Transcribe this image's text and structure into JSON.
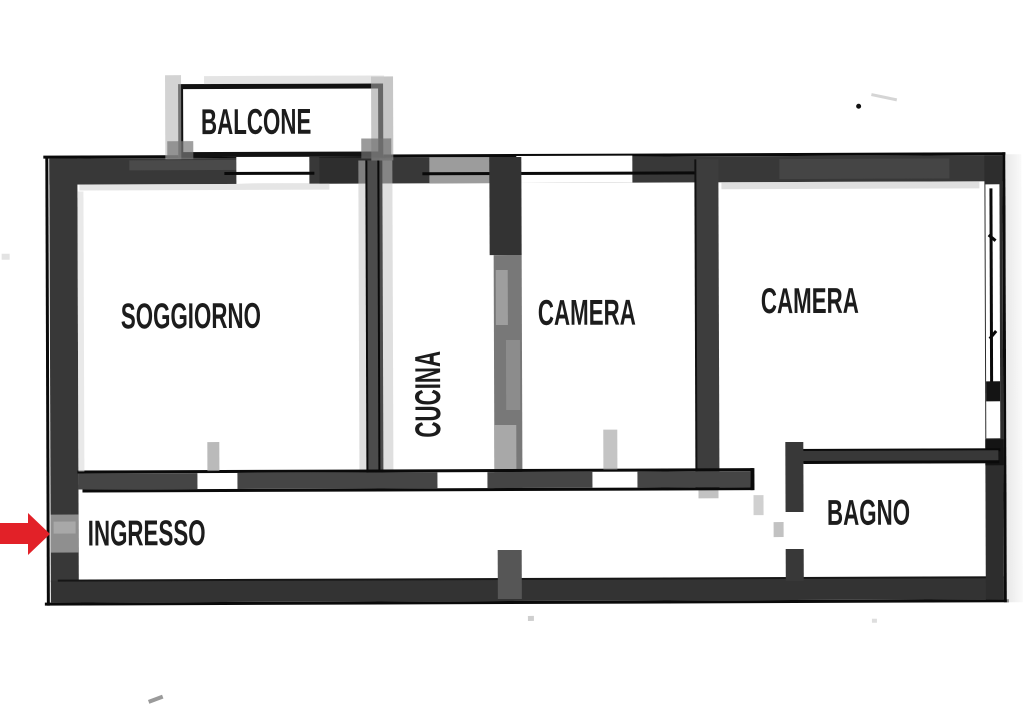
{
  "floorplan": {
    "type": "apartment-floor-plan",
    "rooms": [
      {
        "id": "balcone",
        "label": "BALCONE"
      },
      {
        "id": "soggiorno",
        "label": "SOGGIORNO"
      },
      {
        "id": "cucina",
        "label": "CUCINA",
        "label_orientation": "vertical"
      },
      {
        "id": "camera-1",
        "label": "CAMERA"
      },
      {
        "id": "camera-2",
        "label": "CAMERA"
      },
      {
        "id": "ingresso",
        "label": "INGRESSO"
      },
      {
        "id": "bagno",
        "label": "BAGNO"
      }
    ],
    "entrance_marker": {
      "icon": "arrow-right",
      "points_to": "INGRESSO",
      "color": "#e22128"
    },
    "colors": {
      "background": "#ffffff",
      "walls_dark": "#383838",
      "wall_lines": "#0a0a0a",
      "text": "#1c1c1c",
      "arrow_red": "#e22128"
    }
  }
}
